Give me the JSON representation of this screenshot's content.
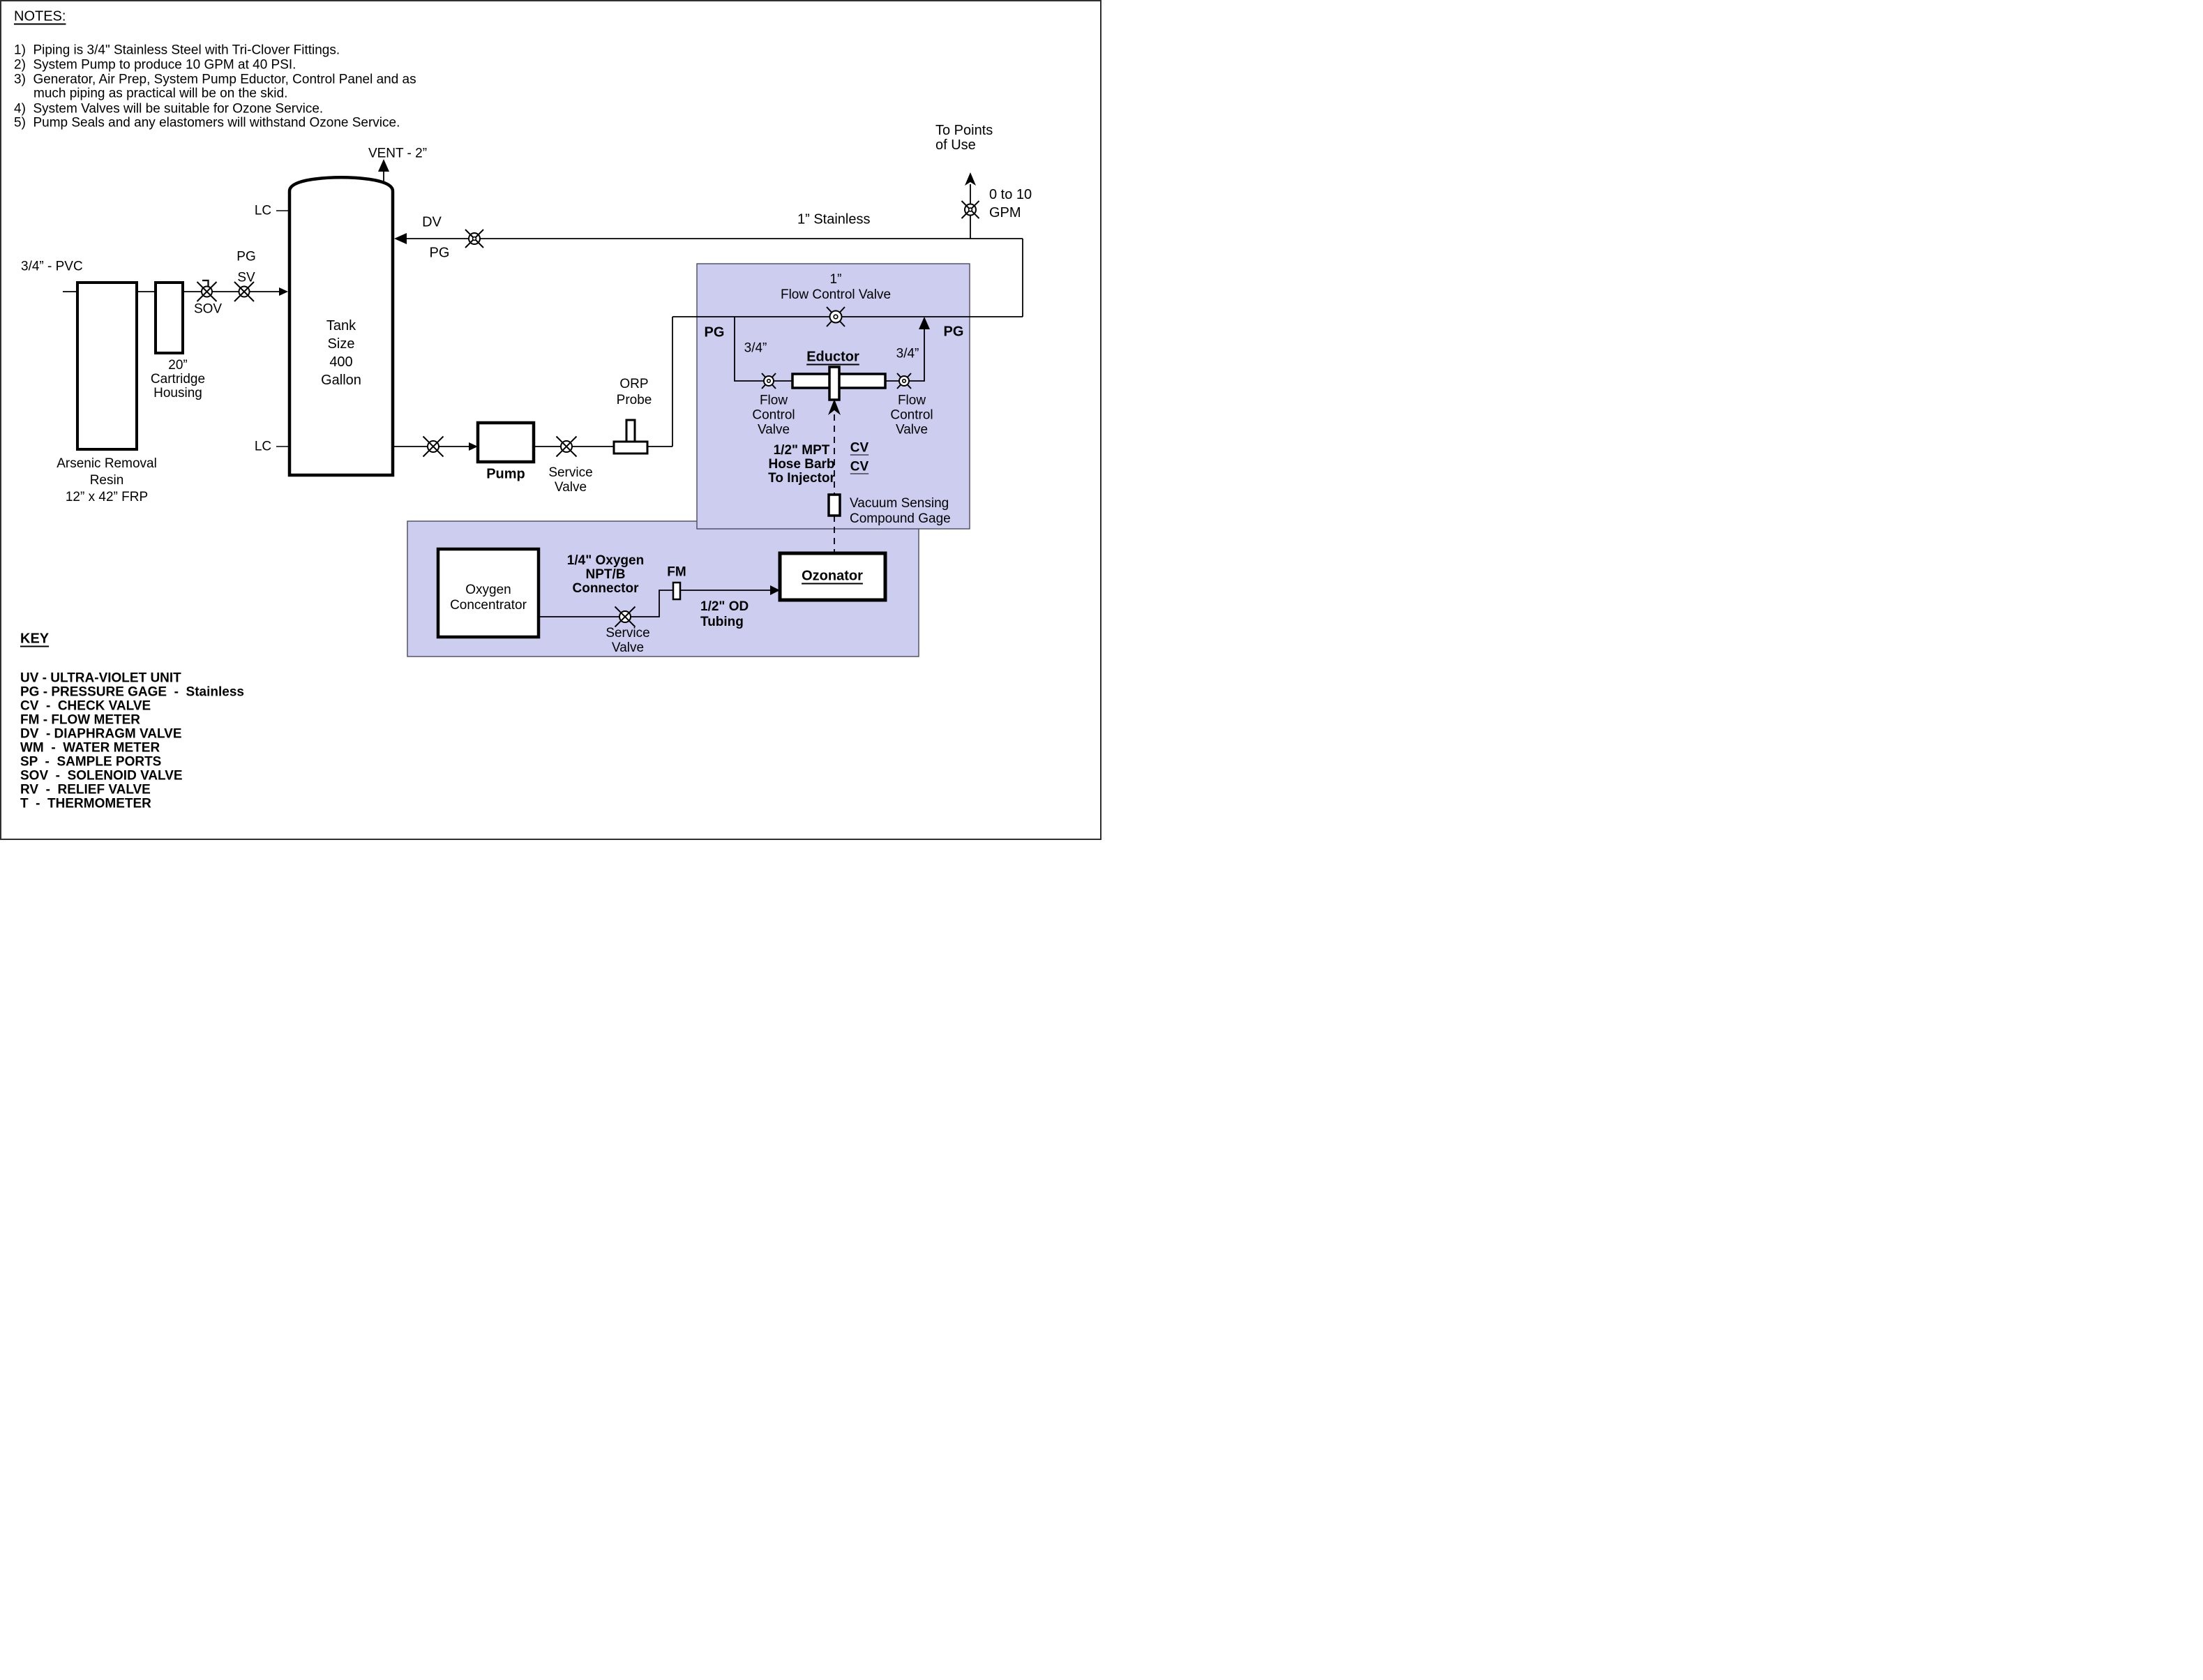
{
  "notes": {
    "title": "NOTES:",
    "lines": [
      "1)  Piping is 3/4\" Stainless Steel with Tri-Clover Fittings.",
      "2)  System Pump to produce 10 GPM at 40 PSI.",
      "3)  Generator, Air Prep, System Pump Eductor, Control Panel and as",
      "much piping as practical will be on the skid.",
      "4)  System Valves will be suitable for Ozone Service.",
      "5)  Pump Seals and any elastomers will withstand Ozone Service."
    ]
  },
  "key": {
    "title": "KEY",
    "entries": [
      "UV - ULTRA-VIOLET UNIT",
      "PG - PRESSURE GAGE  -  Stainless",
      "CV  -  CHECK VALVE",
      "FM - FLOW METER",
      "DV  - DIAPHRAGM VALVE",
      "WM  -  WATER METER",
      "SP  -  SAMPLE PORTS",
      "SOV  -  SOLENOID VALVE",
      "RV  -  RELIEF VALVE",
      "T  -  THERMOMETER"
    ]
  },
  "feed": {
    "pipe_label": "3/4” - PVC",
    "arsenic_label": "Arsenic Removal\nResin\n12” x 42” FRP",
    "cartridge_label": "20”\nCartridge\nHousing",
    "sov_label": "SOV",
    "pg_label": "PG",
    "sv_label": "SV"
  },
  "tank": {
    "label": "Tank\nSize\n400\nGallon",
    "vent_label": "VENT - 2”",
    "lc_top": "LC",
    "lc_bottom": "LC",
    "dv_label": "DV",
    "pg_label": "PG"
  },
  "process": {
    "pump_label": "Pump",
    "service_valve_label": "Service\nValve",
    "orp_label": "ORP\nProbe",
    "stainless_label": "1” Stainless",
    "to_points_label": "To Points\nof Use",
    "gpm_label": "0 to 10\nGPM"
  },
  "skid": {
    "fcv_main_label": "1”\nFlow Control Valve",
    "pg_left": "PG",
    "pg_right": "PG",
    "branch_left_size": "3/4”",
    "branch_right_size": "3/4”",
    "eductor_label": "Eductor",
    "fcv_left_label": "Flow\nControl\nValve",
    "fcv_right_label": "Flow\nControl\nValve",
    "injector_label": "1/2\" MPT\nHose Barb\nTo Injector",
    "cv1": "CV",
    "cv2": "CV",
    "gauge_label": "Vacuum Sensing\nCompound Gage"
  },
  "oxygen": {
    "concentrator_label": "Oxygen\nConcentrator",
    "connector_label": "1/4\" Oxygen\nNPT/B\nConnector",
    "fm_label": "FM",
    "service_valve_label": "Service\nValve",
    "tubing_label": "1/2\" OD\nTubing",
    "ozonator_label": "Ozonator"
  },
  "colors": {
    "skid_fill": "#cdcdf0",
    "skid_border": "#4a4a63",
    "line": "#000000"
  }
}
